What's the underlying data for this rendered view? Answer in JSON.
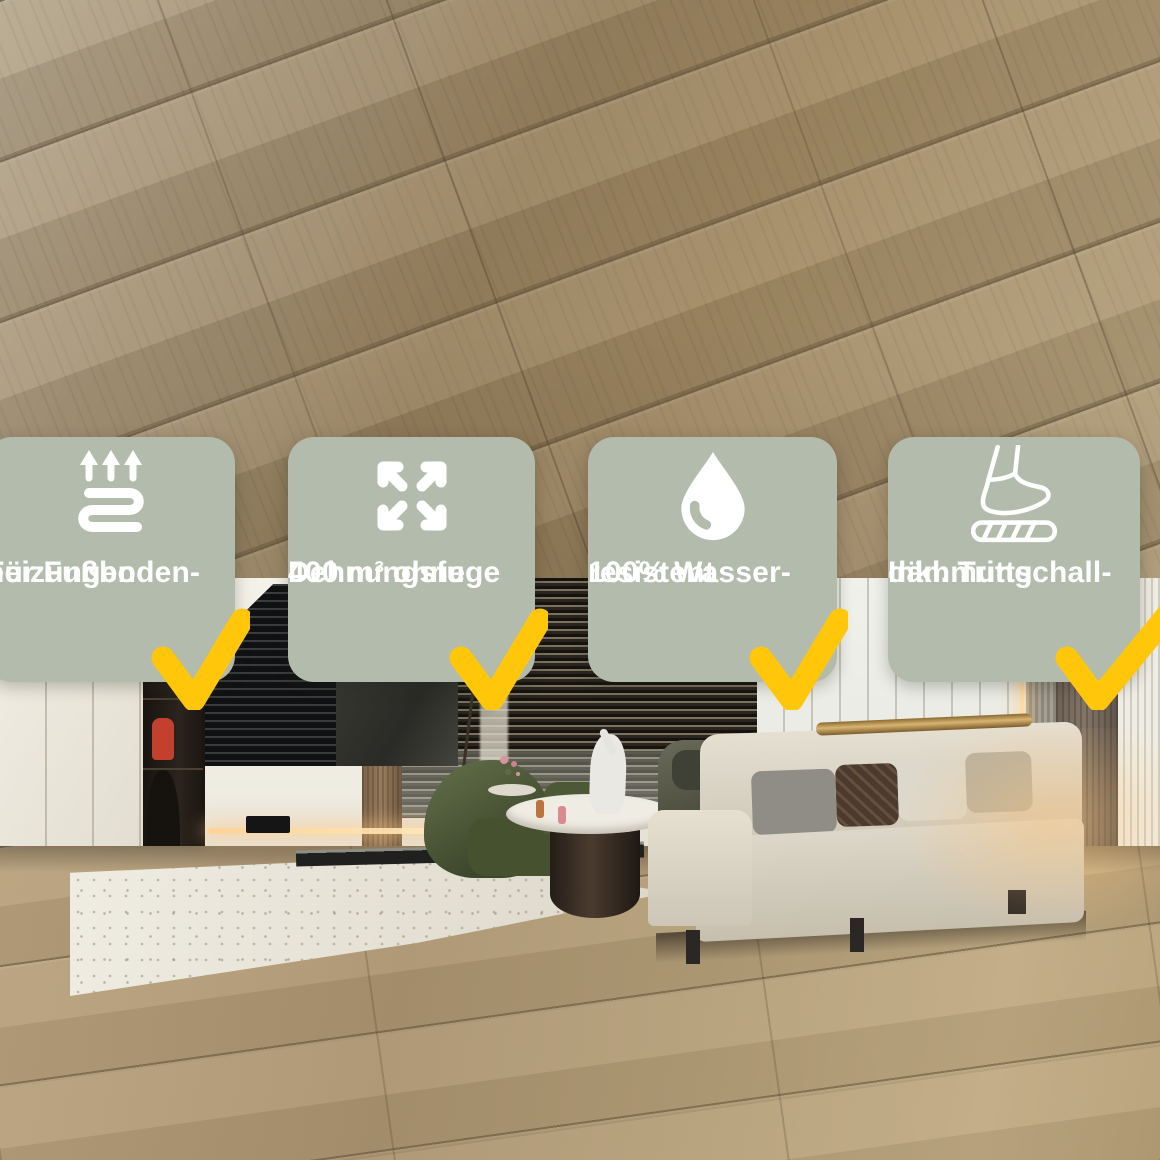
{
  "image_type": "product-feature-photo",
  "colors": {
    "badge_background": "#b2bbac",
    "badge_text": "#ffffff",
    "checkmark_yellow": "#ffc60a",
    "wood_light": "#b5a17c",
    "wood_mid": "#a28a64",
    "wood_dark": "#99835f",
    "room_wall": "#f0f1eb"
  },
  "badges": [
    {
      "icon": "underfloor-heating-icon",
      "line1": "Für Fußboden-",
      "line2": "heizungen",
      "checkmark": "yellow-check"
    },
    {
      "icon": "expand-arrows-icon",
      "line1": "400 m³ ohne",
      "line2": "Dehnungsfuge",
      "checkmark": "yellow-check"
    },
    {
      "icon": "water-drop-icon",
      "line1": "100% Wasser-",
      "line2": "resistent",
      "checkmark": "yellow-check"
    },
    {
      "icon": "impact-sound-insulation-icon",
      "line1": "Inkl. Trittschall-",
      "line2": "dämmung",
      "checkmark": "yellow-check"
    }
  ]
}
